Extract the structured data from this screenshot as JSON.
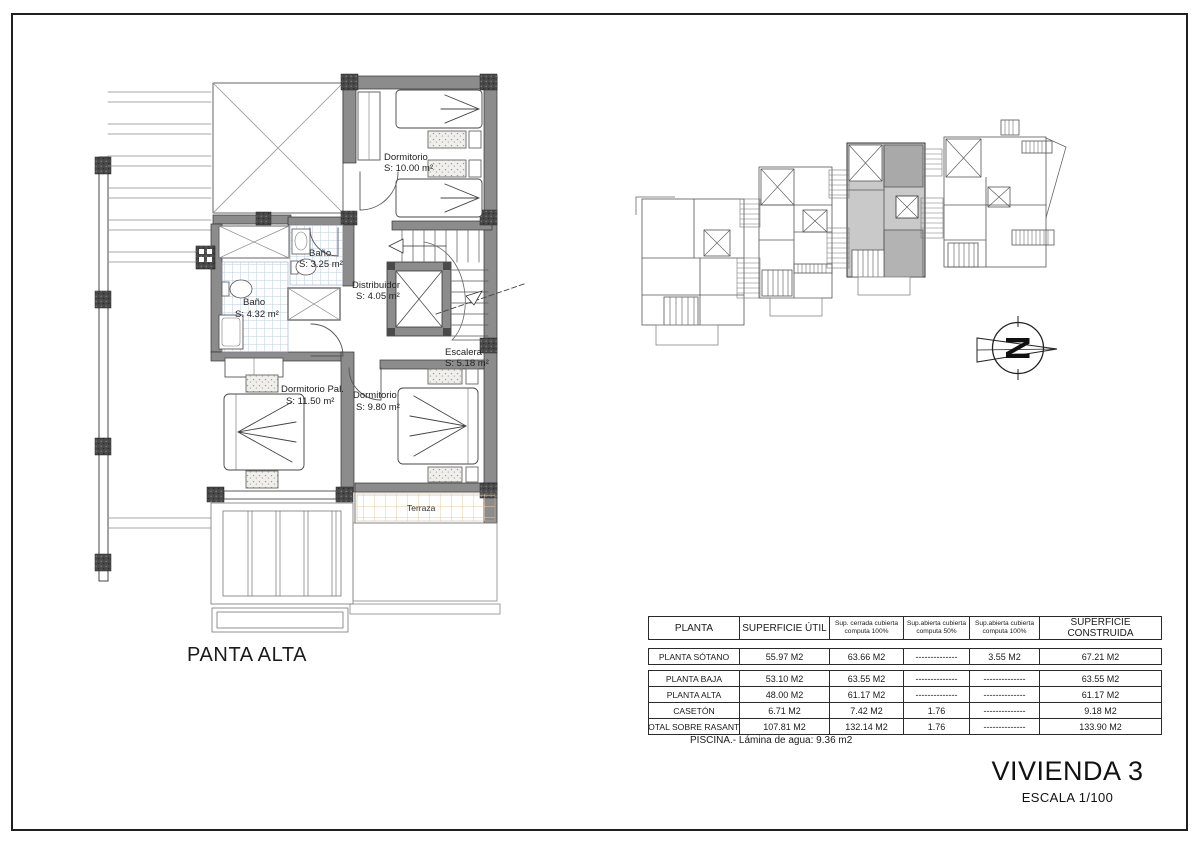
{
  "sheet": {
    "plan_title": "PANTA ALTA",
    "project_title": "VIVIENDA 3",
    "scale_label": "ESCALA 1/100"
  },
  "floor_plan": {
    "rooms": {
      "dormitorio_top": {
        "name": "Dormitorio",
        "area": "S: 10.00 m²"
      },
      "bano_small": {
        "name": "Baño",
        "area": "S: 3.25 m²"
      },
      "bano_large": {
        "name": "Baño",
        "area": "S: 4.32 m²"
      },
      "distribuidor": {
        "name": "Distribuidor",
        "area": "S: 4.05 m²"
      },
      "escalera": {
        "name": "Escalera",
        "area": "S: 5.18 m²"
      },
      "dormitorio_pal": {
        "name": "Dormitorio Pal.",
        "area": "S: 11.50 m²"
      },
      "dormitorio_right": {
        "name": "Dormitorio",
        "area": "S: 9.80 m²"
      },
      "terraza": {
        "name": "Terraza"
      }
    }
  },
  "north_arrow": {
    "letter": "N"
  },
  "areas_table": {
    "headers": [
      "PLANTA",
      "SUPERFICIE ÚTIL",
      "Sup. cerrada cubierta computa 100%",
      "Sup.abierta cubierta computa 50%",
      "Sup.abierta cubierta computa 100%",
      "SUPERFICIE CONSTRUIDA"
    ],
    "rows": [
      {
        "cells": [
          "PLANTA SÓTANO",
          "55.97 M2",
          "63.66 M2",
          "--------------",
          "3.55 M2",
          "67.21 M2"
        ]
      },
      {
        "cells": [
          "PLANTA BAJA",
          "53.10 M2",
          "63.55 M2",
          "--------------",
          "--------------",
          "63.55 M2"
        ]
      },
      {
        "cells": [
          "PLANTA ALTA",
          "48.00 M2",
          "61.17 M2",
          "--------------",
          "--------------",
          "61.17 M2"
        ]
      },
      {
        "cells": [
          "CASETÓN",
          "6.71 M2",
          "7.42 M2",
          "1.76",
          "--------------",
          "9.18 M2"
        ]
      },
      {
        "cells": [
          "TOTAL SOBRE RASANTE",
          "107.81 M2",
          "132.14 M2",
          "1.76",
          "--------------",
          "133.90 M2"
        ]
      }
    ]
  },
  "pool_note": "PISCINA.- Lámina de agua: 9.36 m2",
  "colors": {
    "wall_gray": "#8c8c8c",
    "corner_dark": "#4a4a4a",
    "tile_blue": "#bccde8",
    "tile_orange": "#eac9a2",
    "site_highlight": "#c9c9c9"
  }
}
